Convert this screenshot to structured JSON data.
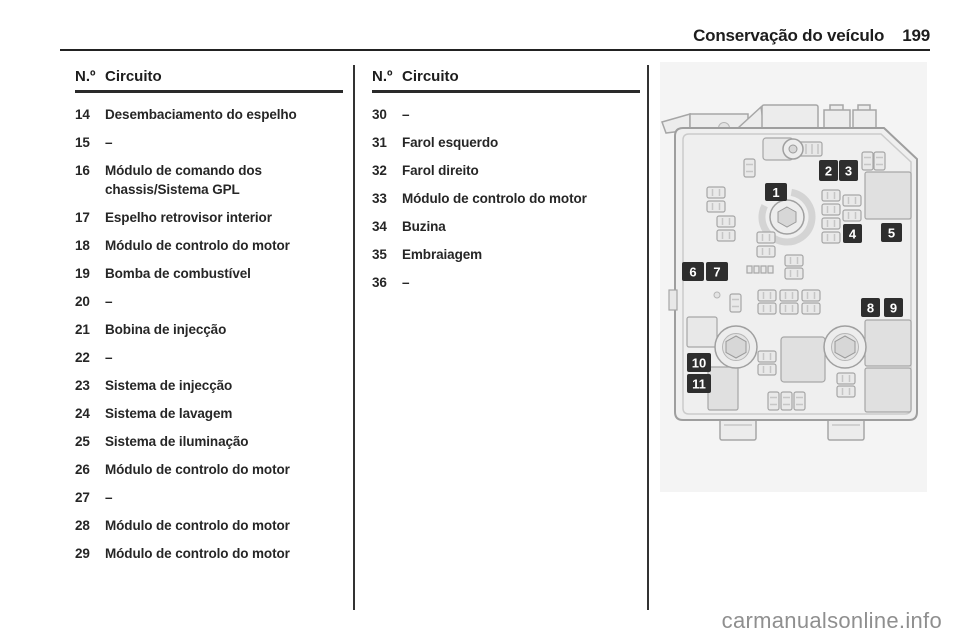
{
  "page": {
    "title": "Conservação do veículo",
    "number": "199"
  },
  "tables": {
    "header_no": "N.º",
    "header_circuit": "Circuito",
    "left_rows": [
      {
        "no": "14",
        "circuit": "Desembaciamento do espelho"
      },
      {
        "no": "15",
        "circuit": "–"
      },
      {
        "no": "16",
        "circuit": "Módulo de comando dos chassis/Sistema GPL"
      },
      {
        "no": "17",
        "circuit": "Espelho retrovisor interior"
      },
      {
        "no": "18",
        "circuit": "Módulo de controlo do motor"
      },
      {
        "no": "19",
        "circuit": "Bomba de combustível"
      },
      {
        "no": "20",
        "circuit": "–"
      },
      {
        "no": "21",
        "circuit": "Bobina de injecção"
      },
      {
        "no": "22",
        "circuit": "–"
      },
      {
        "no": "23",
        "circuit": "Sistema de injecção"
      },
      {
        "no": "24",
        "circuit": "Sistema de lavagem"
      },
      {
        "no": "25",
        "circuit": "Sistema de iluminação"
      },
      {
        "no": "26",
        "circuit": "Módulo de controlo do motor"
      },
      {
        "no": "27",
        "circuit": "–"
      },
      {
        "no": "28",
        "circuit": "Módulo de controlo do motor"
      },
      {
        "no": "29",
        "circuit": "Módulo de controlo do motor"
      }
    ],
    "right_rows": [
      {
        "no": "30",
        "circuit": "–"
      },
      {
        "no": "31",
        "circuit": "Farol esquerdo"
      },
      {
        "no": "32",
        "circuit": "Farol direito"
      },
      {
        "no": "33",
        "circuit": "Módulo de controlo do motor"
      },
      {
        "no": "34",
        "circuit": "Buzina"
      },
      {
        "no": "35",
        "circuit": "Embraiagem"
      },
      {
        "no": "36",
        "circuit": "–"
      }
    ]
  },
  "figure": {
    "callouts": [
      "1",
      "2",
      "3",
      "4",
      "5",
      "6",
      "7",
      "8",
      "9",
      "10",
      "11"
    ]
  },
  "watermark": "carmanualsonline.info",
  "colors": {
    "text": "#262626",
    "rule": "#222222",
    "figure_bg": "#f4f4f4",
    "callout_bg": "#2e2e2e",
    "watermark": "#8f8f8f"
  }
}
